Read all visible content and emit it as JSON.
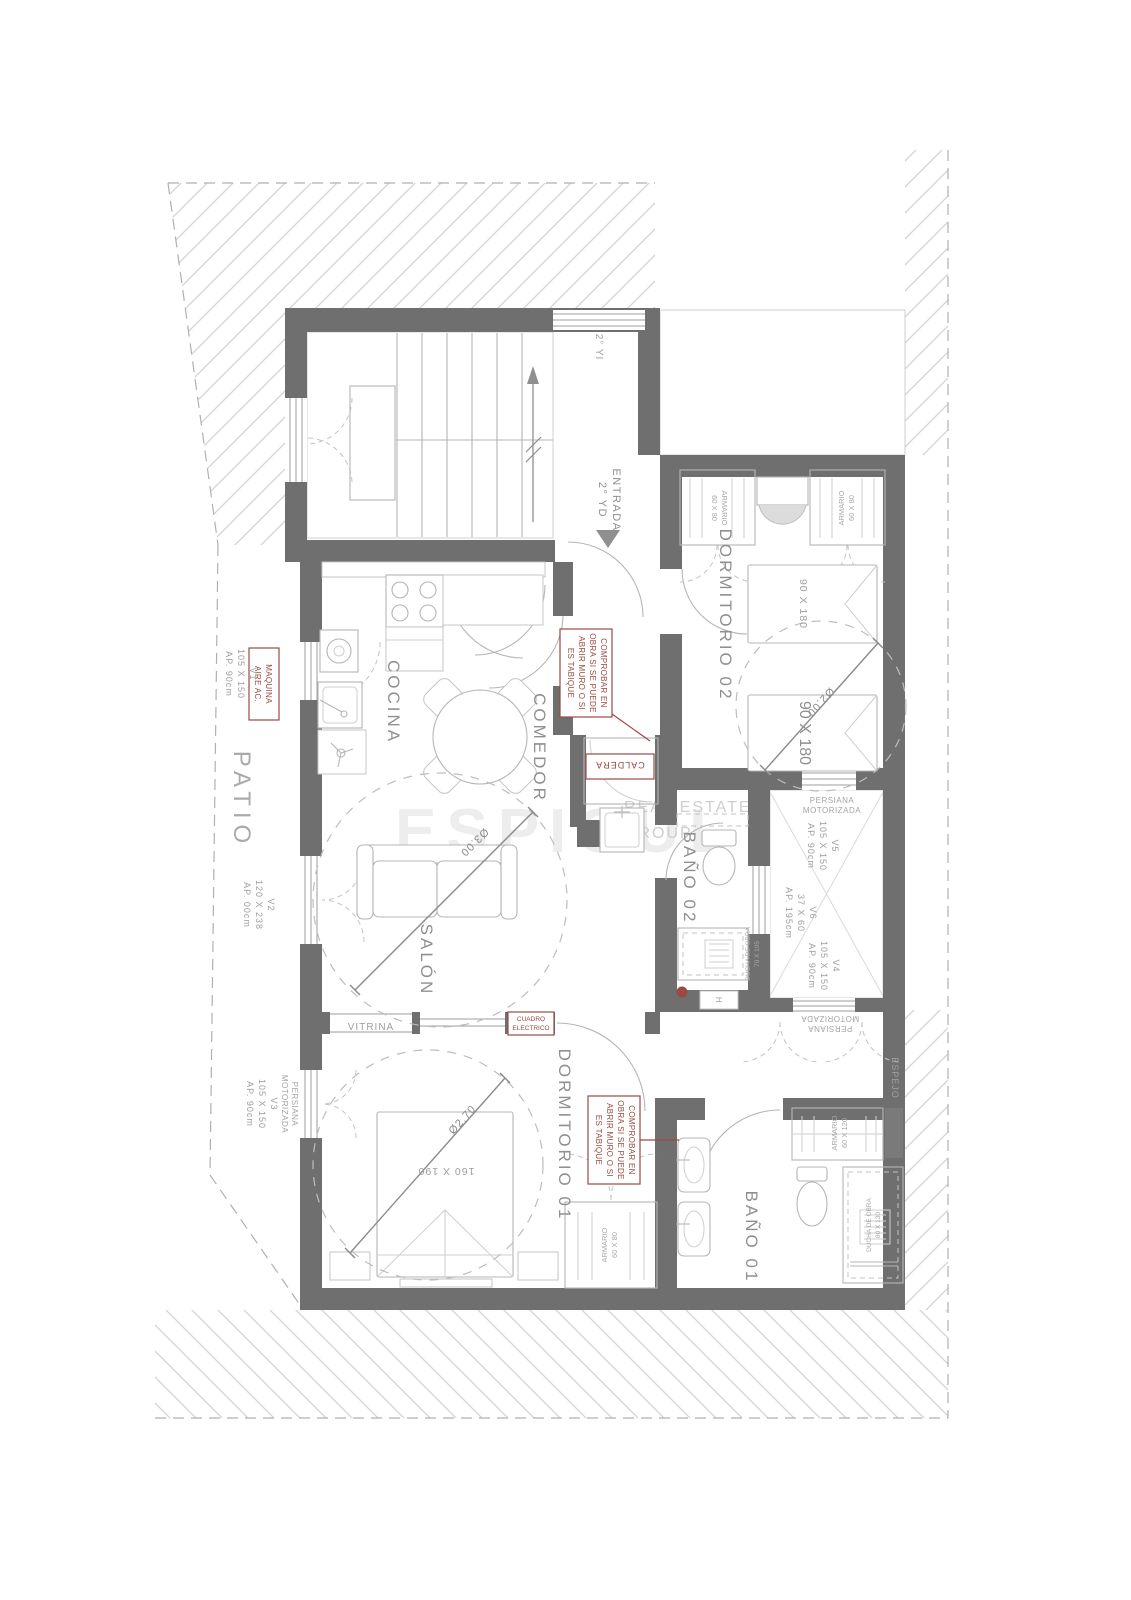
{
  "watermark": {
    "name": "ESPIGUL",
    "line1": "REAL ESTATE",
    "line2": "GROUP"
  },
  "rooms": {
    "stair_unit": "2° YI",
    "entrance_l1": "ENTRADA",
    "entrance_l2": "2° YD",
    "bedroom2": "DORMITORIO 02",
    "kitchen": "COCINA",
    "dining": "COMEDOR",
    "living": "SALÓN",
    "bath2": "BAÑO 02",
    "bedroom1": "DORMITORIO 01",
    "bath1": "BAÑO 01",
    "patio": "PATIO",
    "mirror": "ESPEJO",
    "vitrine": "VITRINA",
    "towel_mark": "H"
  },
  "windows": {
    "v1": {
      "id": "V1",
      "size": "105 X 150",
      "sill": "AP. 90cm"
    },
    "v2": {
      "id": "V2",
      "size": "120 X 238",
      "sill": "AP. 00cm"
    },
    "v3": {
      "id": "V3",
      "size": "105 X 150",
      "sill": "AP. 90cm"
    },
    "v4": {
      "id": "V4",
      "size": "105 X 150",
      "sill": "AP. 90cm"
    },
    "v5": {
      "id": "V5",
      "size": "105 X 150",
      "sill": "AP. 90cm"
    },
    "v6": {
      "id": "V6",
      "size": "37 X 60",
      "sill": "AP. 195cm"
    },
    "shutter_l1": "PERSIANA",
    "shutter_l2": "MOTORIZADA"
  },
  "notes": {
    "check_l1": "COMPROBAR EN",
    "check_l2": "OBRA SI SE PUEDE",
    "check_l3": "ABRIR MURO O SI",
    "check_l4": "ES TABIQUE",
    "boiler": "CALDERA",
    "ac_l1": "MAQUINA",
    "ac_l2": "AIRE AC.",
    "panel_l1": "CUADRO",
    "panel_l2": "ELECTRICO"
  },
  "furniture": {
    "single_bed": "90 X 180",
    "double_bed": "160 X 190",
    "wardrobe_s_l1": "ARMARIO",
    "wardrobe_s_l2": "60 X 80",
    "wardrobe_l_l1": "ARMARIO",
    "wardrobe_l_l2": "60 X 120",
    "shower_l1": "DUCHA DE OBRA",
    "shower2_size": "70 X 105",
    "shower1_size": "80 X 130"
  },
  "dimensions": {
    "living_circle": "Ø3.00",
    "bed2_circle": "Ø2.00",
    "bed1_circle": "Ø2.70"
  },
  "colors": {
    "wall": "#6f6f6f",
    "line": "#b5b5b5",
    "hatch": "#d2d2d2",
    "label": "#8f8f8f",
    "accent_red": "#9a4a42",
    "watermark": "#ececec",
    "paper": "#ffffff"
  }
}
